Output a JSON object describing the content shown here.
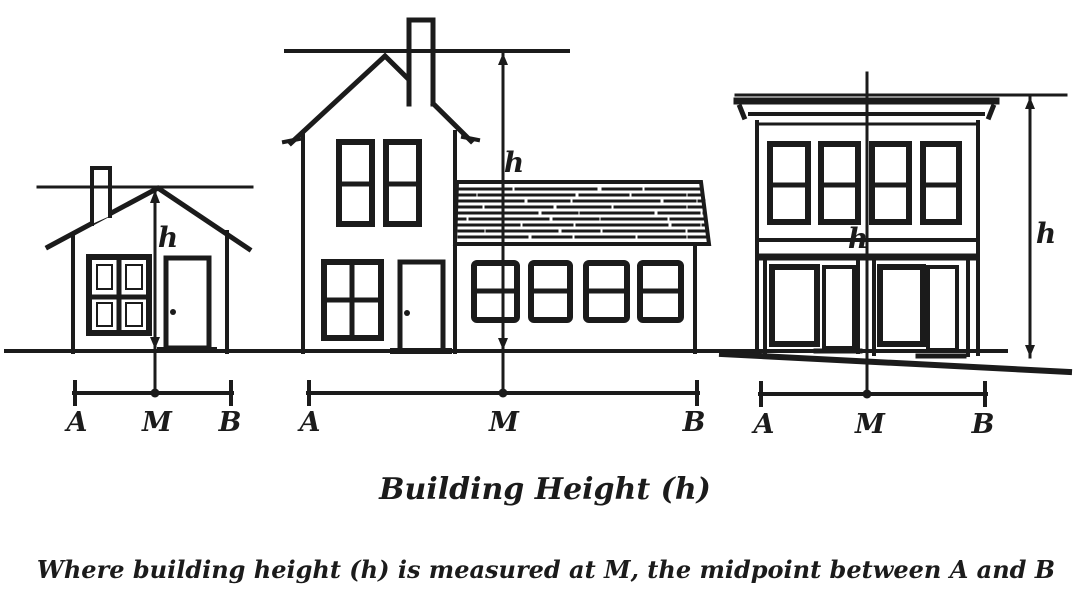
{
  "colors": {
    "ink": "#1b1b1b",
    "paper": "#ffffff"
  },
  "caption": "Building Height (h)",
  "note": "Where building height (h) is measured at M, the midpoint between A and B",
  "height_label": "h",
  "dimension_labels": {
    "a": "A",
    "m": "M",
    "b": "B"
  }
}
